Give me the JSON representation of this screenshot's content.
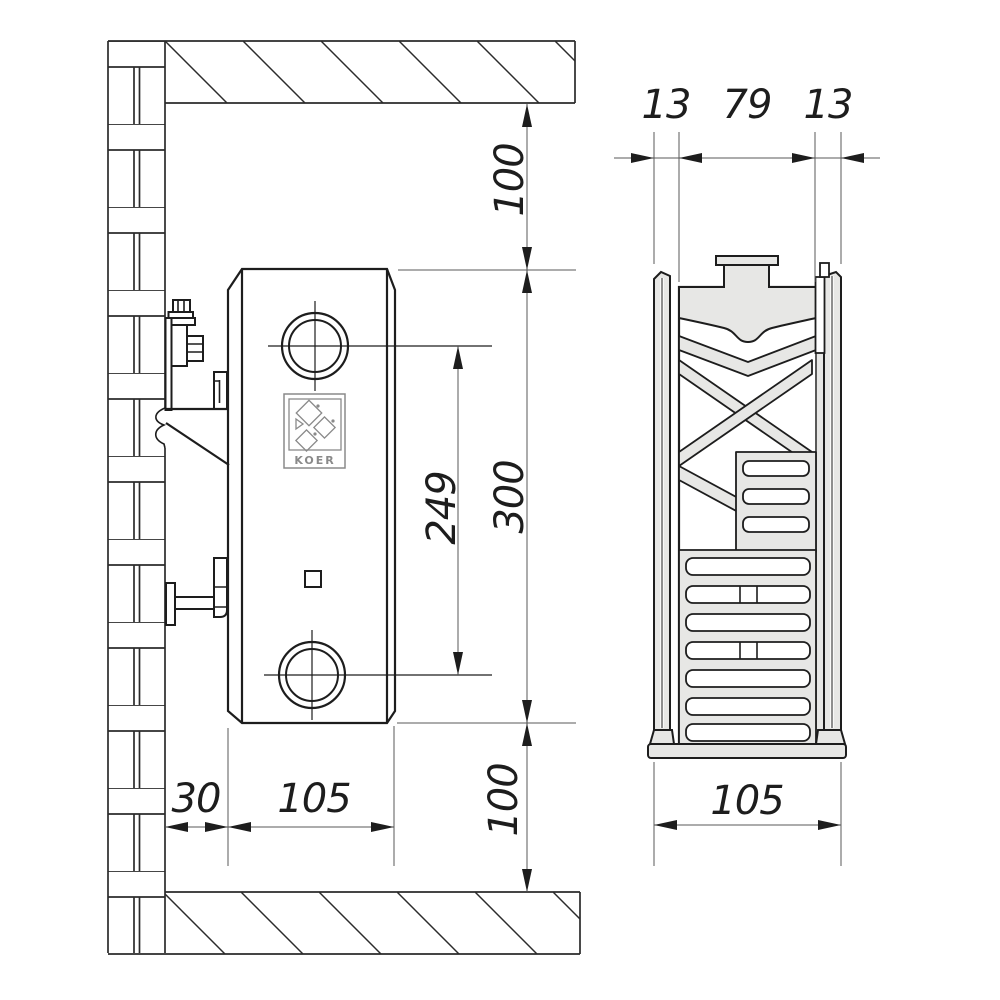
{
  "colors": {
    "line": "#1d1d1d",
    "thin_line": "#5a5a5a",
    "fill_light_gray": "#e7e7e5",
    "background": "#ffffff",
    "logo_gray": "#8a8a8a"
  },
  "front_view": {
    "top_clearance": "100",
    "height": "300",
    "port_spacing": "249",
    "bottom_clearance": "100",
    "wall_offset": "30",
    "depth": "105",
    "logo": "KOER"
  },
  "section_view": {
    "front_panel": "13",
    "core": "79",
    "back_panel": "13",
    "depth": "105"
  }
}
